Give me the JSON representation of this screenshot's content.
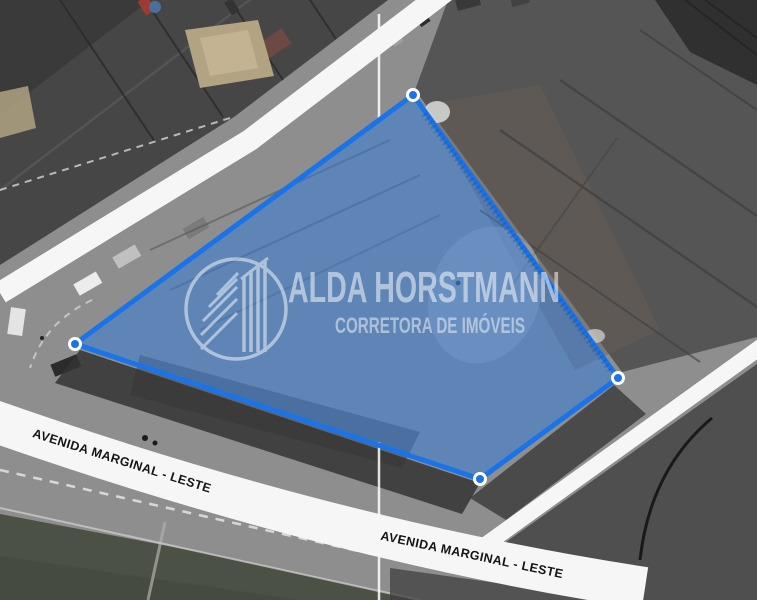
{
  "scene": {
    "kind": "aerial-photo-with-property-outline",
    "width": 757,
    "height": 600
  },
  "watermark": {
    "title": "ALDA HORSTMANN",
    "subtitle": "CORRETORA DE IMÓVEIS",
    "logo_icon": "twin-buildings-circle-logo",
    "color": "#ffffff"
  },
  "streets": {
    "left_label": "AVENIDA MARGINAL - LESTE",
    "right_label": "AVENIDA MARGINAL - LESTE",
    "band_color": "#f6f6f6",
    "label_color": "#141414"
  },
  "property_overlay": {
    "polygon_points": "413,95 618,378 480,479 75,344",
    "stroke_color": "#1a73e8",
    "fill_color": "#2f7ce0",
    "fill_opacity": "0.5",
    "vertex_fill": "#1a73e8",
    "vertex_ring_color": "#ffffff",
    "vertices": [
      {
        "x": 413,
        "y": 95
      },
      {
        "x": 618,
        "y": 378
      },
      {
        "x": 480,
        "y": 479
      },
      {
        "x": 75,
        "y": 344
      }
    ]
  }
}
